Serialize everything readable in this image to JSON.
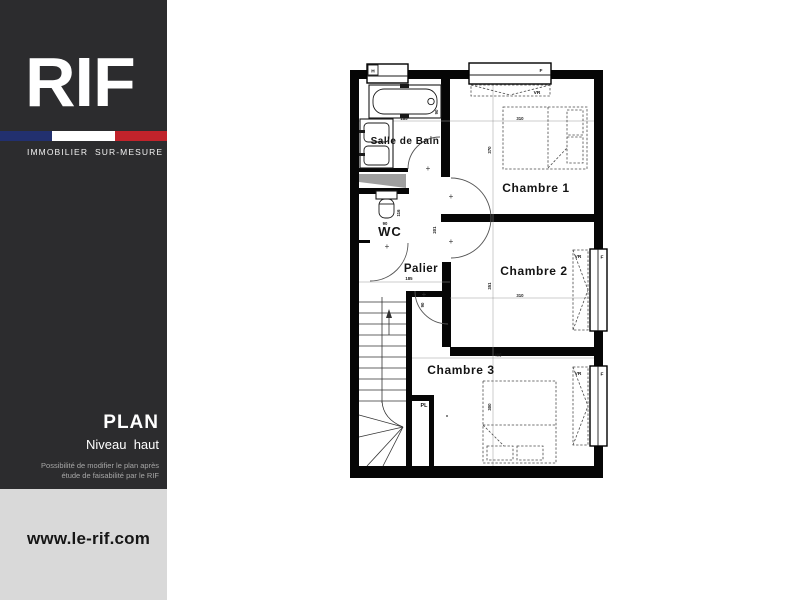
{
  "sidebar": {
    "logo": "RIF",
    "tagline": "IMMOBILIER  SUR-MESURE",
    "plan_title": "PLAN",
    "plan_subtitle": "Niveau  haut",
    "note_line1": "Possibilité de modifier le plan après",
    "note_line2": "étude de faisabilité par le RIF",
    "website": "www.le-rif.com",
    "colors": {
      "panel": "#2c2c2e",
      "footer_panel": "#d9d9d9",
      "flag_blue": "#22306f",
      "flag_white": "#ffffff",
      "flag_red": "#c1232b"
    }
  },
  "plan": {
    "labels": {
      "chambre1": "Chambre 1",
      "chambre2": "Chambre 2",
      "chambre3": "Chambre 3",
      "salle_de_bain": "Salle de Bain",
      "wc": "WC",
      "palier": "Palier",
      "placard": "PL",
      "window_h": "H",
      "window_f": "F",
      "shutter": "VR"
    },
    "dimensions": {
      "tub_width": "185",
      "tub_offset": "90",
      "chambre1_width": "310",
      "chambre1_depth": "370",
      "palier_width": "185",
      "palier_depth": "201",
      "palier_door": "90",
      "wc_width": "90",
      "wc_depth": "116",
      "chambre2_width": "310",
      "chambre2_depth": "351",
      "chambre3_width": "405",
      "chambre3_depth": "300"
    },
    "misc": {
      "plus": "+"
    }
  }
}
